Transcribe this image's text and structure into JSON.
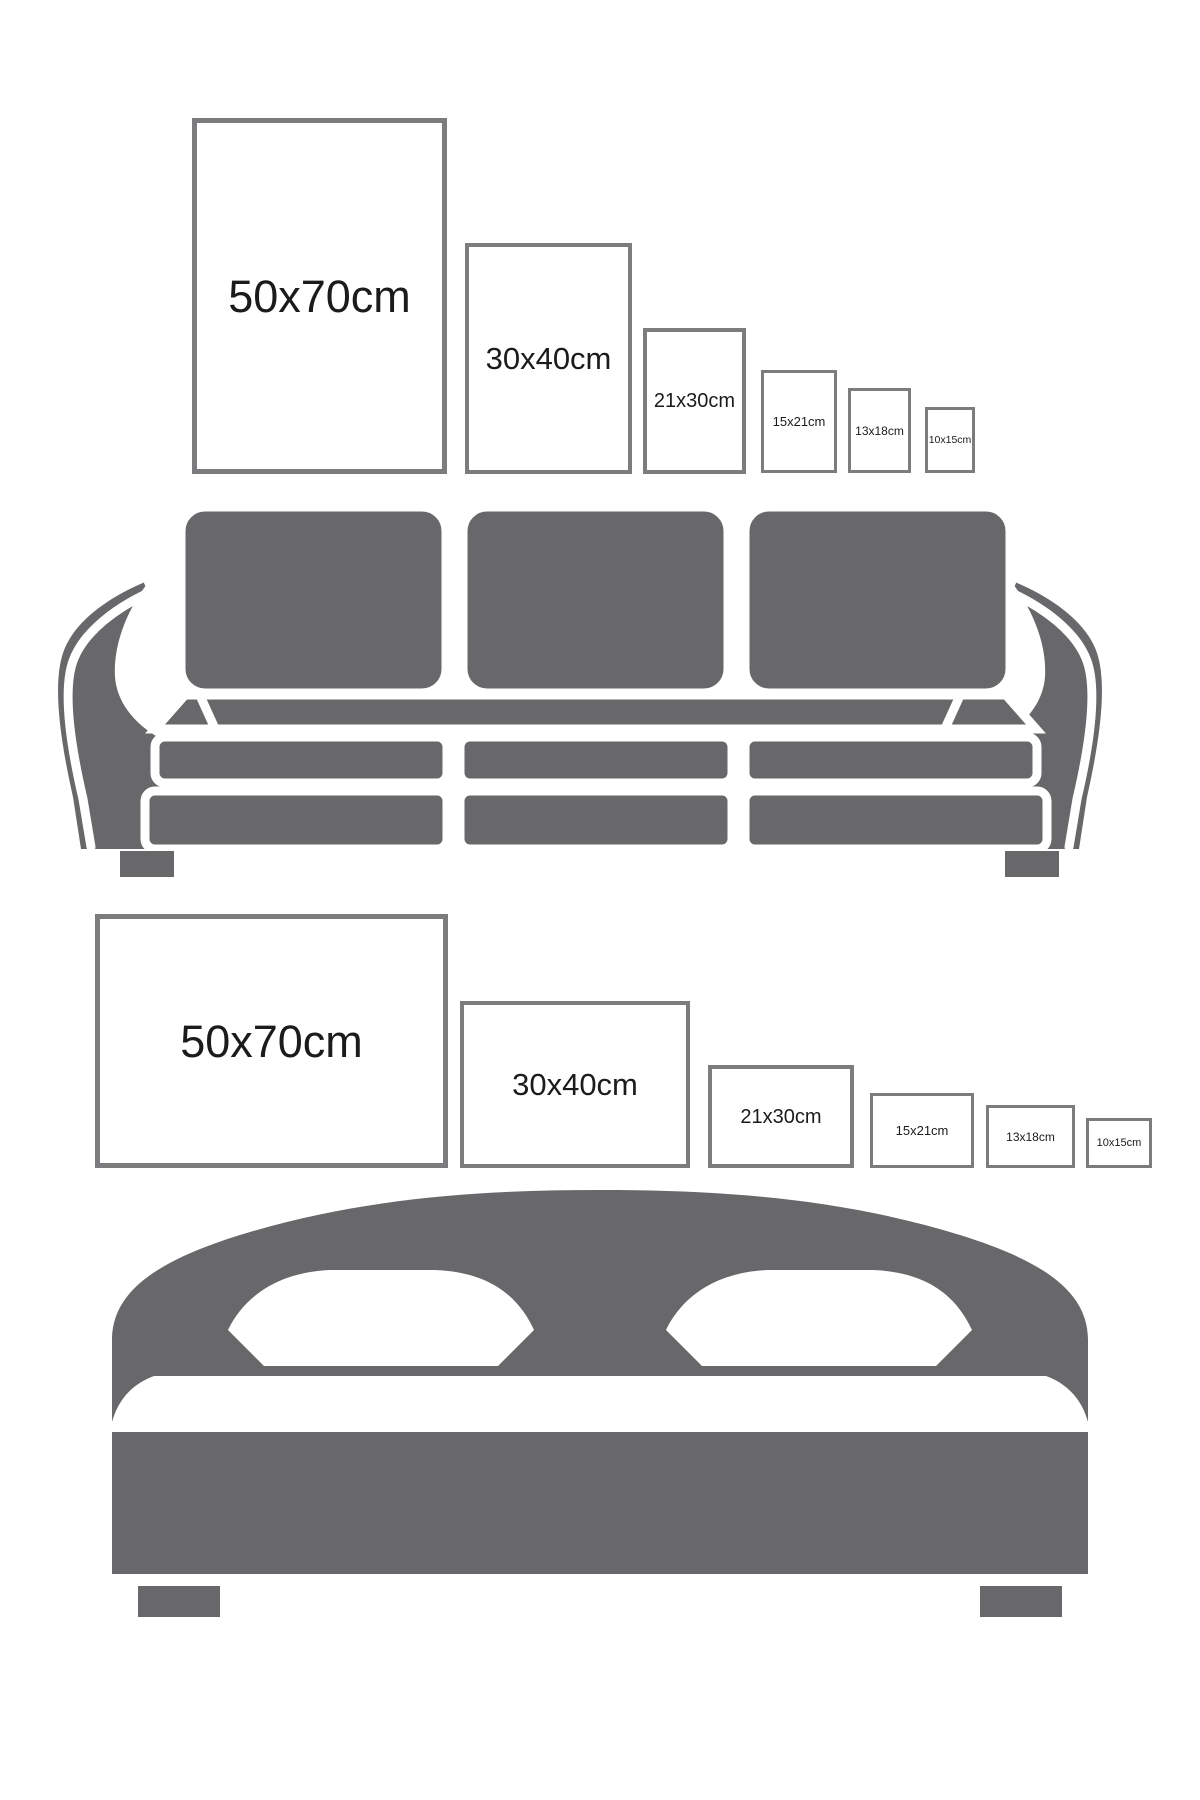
{
  "colors": {
    "background": "#ffffff",
    "furniture": "#68686b",
    "frame_border": "#7c7c7f",
    "frame_fill": "#ffffff",
    "label_text": "#1b1b1b"
  },
  "portrait_row": {
    "context": "poster sizes shown above sofa",
    "orientation": "portrait",
    "frames": [
      {
        "label": "50x70cm",
        "width_cm": 50,
        "height_cm": 70
      },
      {
        "label": "30x40cm",
        "width_cm": 30,
        "height_cm": 40
      },
      {
        "label": "21x30cm",
        "width_cm": 21,
        "height_cm": 30
      },
      {
        "label": "15x21cm",
        "width_cm": 15,
        "height_cm": 21
      },
      {
        "label": "13x18cm",
        "width_cm": 13,
        "height_cm": 18
      },
      {
        "label": "10x15cm",
        "width_cm": 10,
        "height_cm": 15
      }
    ]
  },
  "landscape_row": {
    "context": "poster sizes shown above bed",
    "orientation": "landscape",
    "frames": [
      {
        "label": "50x70cm",
        "width_cm": 70,
        "height_cm": 50
      },
      {
        "label": "30x40cm",
        "width_cm": 40,
        "height_cm": 30
      },
      {
        "label": "21x30cm",
        "width_cm": 30,
        "height_cm": 21
      },
      {
        "label": "15x21cm",
        "width_cm": 21,
        "height_cm": 15
      },
      {
        "label": "13x18cm",
        "width_cm": 18,
        "height_cm": 13
      },
      {
        "label": "10x15cm",
        "width_cm": 15,
        "height_cm": 10
      }
    ]
  },
  "illustrations": {
    "sofa": "three-seat sofa silhouette",
    "bed": "double bed with two pillows silhouette"
  }
}
